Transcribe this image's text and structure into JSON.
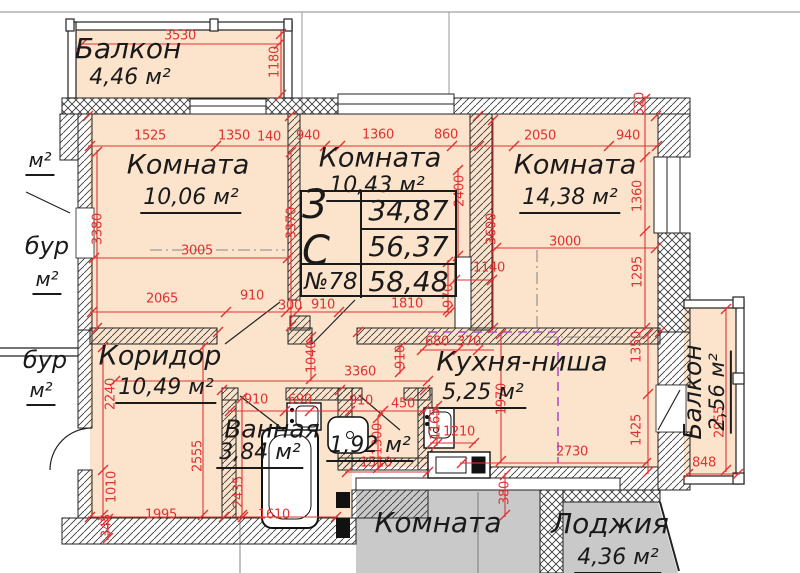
{
  "colors": {
    "room_fill": "#fbe3cc",
    "dimension_red": "#e03232",
    "neighbor_gray": "#c9c9c9",
    "niche_dashed": "#b050c8",
    "wall_ink": "#222222"
  },
  "unit_card": {
    "type_label": "3 С",
    "unit_number": "№78",
    "areas": [
      "34,87",
      "56,37",
      "58,48"
    ]
  },
  "rooms": [
    {
      "name": "Балкон",
      "area": "4,46 м²"
    },
    {
      "name": "Комната",
      "area": "10,06 м²"
    },
    {
      "name": "Комната",
      "area": "10,43 м²"
    },
    {
      "name": "Комната",
      "area": "14,38 м²"
    },
    {
      "name": "Коридор",
      "area": "10,49 м²"
    },
    {
      "name": "Кухня-ниша",
      "area": "5,25 м²"
    },
    {
      "name": "Ванная",
      "area": "3,84 м²"
    },
    {
      "name": "",
      "area": "1,92 м²"
    },
    {
      "name": "Балкон",
      "area": "2,56 м²"
    }
  ],
  "neighbor": {
    "room": "Комната",
    "loggia": "Лоджия",
    "loggia_area": "4,36 м²"
  },
  "side_labels": [
    {
      "text": "м²"
    },
    {
      "text": "бур"
    },
    {
      "text": "м²"
    },
    {
      "text": "бур"
    },
    {
      "text": "м²"
    }
  ],
  "dimensions": [
    {
      "v": "3530",
      "x": 180,
      "y": 36,
      "r": 0
    },
    {
      "v": "1180",
      "x": 275,
      "y": 62,
      "r": 1
    },
    {
      "v": "1525",
      "x": 150,
      "y": 136,
      "r": 0
    },
    {
      "v": "1350",
      "x": 234,
      "y": 136,
      "r": 0
    },
    {
      "v": "140",
      "x": 269,
      "y": 137,
      "r": 0
    },
    {
      "v": "940",
      "x": 308,
      "y": 136,
      "r": 0
    },
    {
      "v": "1360",
      "x": 378,
      "y": 135,
      "r": 0
    },
    {
      "v": "860",
      "x": 446,
      "y": 135,
      "r": 0
    },
    {
      "v": "2050",
      "x": 540,
      "y": 136,
      "r": 0
    },
    {
      "v": "940",
      "x": 628,
      "y": 136,
      "r": 0
    },
    {
      "v": "520",
      "x": 640,
      "y": 104,
      "r": 1
    },
    {
      "v": "3380",
      "x": 98,
      "y": 229,
      "r": 1
    },
    {
      "v": "3370",
      "x": 292,
      "y": 223,
      "r": 1
    },
    {
      "v": "2400",
      "x": 460,
      "y": 191,
      "r": 1
    },
    {
      "v": "3600",
      "x": 492,
      "y": 229,
      "r": 1
    },
    {
      "v": "3000",
      "x": 565,
      "y": 242,
      "r": 0
    },
    {
      "v": "1360",
      "x": 638,
      "y": 196,
      "r": 1
    },
    {
      "v": "1295",
      "x": 638,
      "y": 272,
      "r": 1
    },
    {
      "v": "1140",
      "x": 489,
      "y": 268,
      "r": 0
    },
    {
      "v": "970",
      "x": 449,
      "y": 296,
      "r": 1
    },
    {
      "v": "3005",
      "x": 197,
      "y": 251,
      "r": 0
    },
    {
      "v": "2065",
      "x": 162,
      "y": 299,
      "r": 0
    },
    {
      "v": "910",
      "x": 252,
      "y": 296,
      "r": 0
    },
    {
      "v": "300",
      "x": 290,
      "y": 306,
      "r": 0
    },
    {
      "v": "910",
      "x": 323,
      "y": 305,
      "r": 0
    },
    {
      "v": "1810",
      "x": 407,
      "y": 304,
      "r": 0
    },
    {
      "v": "1040",
      "x": 312,
      "y": 357,
      "r": 1
    },
    {
      "v": "3360",
      "x": 360,
      "y": 372,
      "r": 0
    },
    {
      "v": "2240",
      "x": 111,
      "y": 394,
      "r": 1
    },
    {
      "v": "1010",
      "x": 112,
      "y": 487,
      "r": 1
    },
    {
      "v": "345",
      "x": 107,
      "y": 526,
      "r": 1
    },
    {
      "v": "2555",
      "x": 198,
      "y": 456,
      "r": 1
    },
    {
      "v": "2435",
      "x": 239,
      "y": 492,
      "r": 1
    },
    {
      "v": "1995",
      "x": 161,
      "y": 515,
      "r": 0
    },
    {
      "v": "1610",
      "x": 274,
      "y": 515,
      "r": 0
    },
    {
      "v": "680",
      "x": 437,
      "y": 342,
      "r": 0
    },
    {
      "v": "370",
      "x": 469,
      "y": 342,
      "r": 0
    },
    {
      "v": "910",
      "x": 401,
      "y": 357,
      "r": 1
    },
    {
      "v": "1970",
      "x": 502,
      "y": 399,
      "r": 1
    },
    {
      "v": "1350",
      "x": 637,
      "y": 347,
      "r": 1
    },
    {
      "v": "1425",
      "x": 637,
      "y": 430,
      "r": 1
    },
    {
      "v": "2730",
      "x": 572,
      "y": 452,
      "r": 0
    },
    {
      "v": "1210",
      "x": 459,
      "y": 432,
      "r": 0
    },
    {
      "v": "1165",
      "x": 436,
      "y": 424,
      "r": 1
    },
    {
      "v": "450",
      "x": 403,
      "y": 404,
      "r": 0
    },
    {
      "v": "910",
      "x": 256,
      "y": 400,
      "r": 0
    },
    {
      "v": "690",
      "x": 300,
      "y": 400,
      "r": 0
    },
    {
      "v": "910",
      "x": 361,
      "y": 401,
      "r": 0
    },
    {
      "v": "1300",
      "x": 378,
      "y": 439,
      "r": 1
    },
    {
      "v": "1510",
      "x": 376,
      "y": 463,
      "r": 0
    },
    {
      "v": "380",
      "x": 505,
      "y": 493,
      "r": 1
    },
    {
      "v": "2955",
      "x": 720,
      "y": 422,
      "r": 1
    },
    {
      "v": "848",
      "x": 704,
      "y": 463,
      "r": 0
    }
  ]
}
